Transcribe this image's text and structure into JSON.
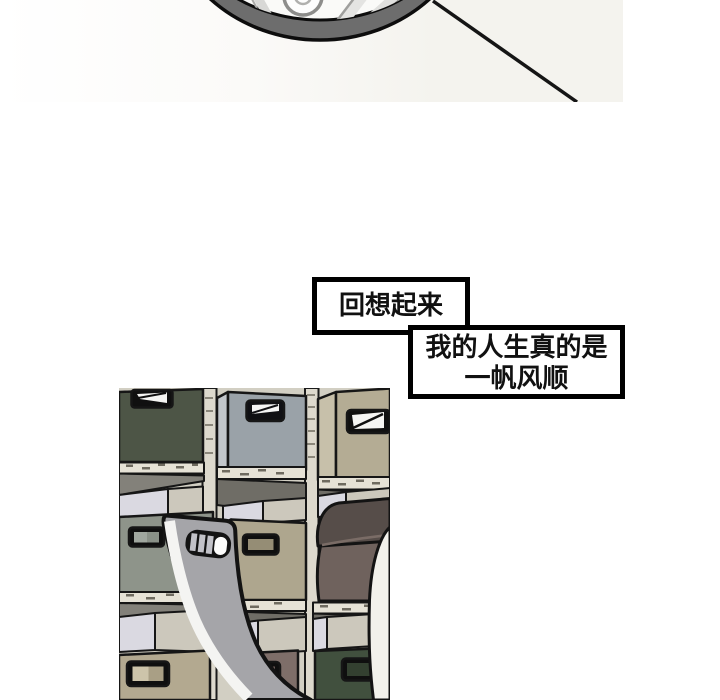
{
  "page": {
    "background_color": "#ffffff",
    "kind": "comic-page"
  },
  "top_panel": {
    "illustration": "bicycle-wheel-bottom-arc-with-frame-line",
    "backdrop_color": "#f4f3ee",
    "tire_color": "#6d6d6d",
    "rim_inner_color": "#fafaf8",
    "line_color": "#151515"
  },
  "speech": {
    "bubble1": {
      "text": "回想起来"
    },
    "bubble2": {
      "line1": "我的人生真的是",
      "line2": "一帆风顺"
    },
    "border_color": "#000000",
    "fill_color": "#ffffff",
    "text_color": "#111111"
  },
  "shelf_panel": {
    "illustration": "storage-cubbies-with-chair-back",
    "colors": {
      "base": "#d2cfc3",
      "frame": "#ddd9cd",
      "shelf_band": "#e6e2d6",
      "shelf_top": "#83817a",
      "shelf_top_dark": "#6f6d66",
      "box_dark_green": "#4d5546",
      "box_blue_gray": "#9aa2a8",
      "box_khaki": "#b4ac94",
      "box_gray_green": "#8e948a",
      "box_khaki2": "#aea68e",
      "box_beige": "#b3a990",
      "box_mauve": "#7e6e69",
      "box_forest": "#41503e",
      "box_top_lavender": "#dad9e1",
      "box_top_greige": "#ccc8bc",
      "chair_gray": "#a5a5a9",
      "chair_highlight": "#f4f4f2",
      "cushion_dark": "#564d49",
      "cushion_front": "#6f625d",
      "white_object": "#f2f1eb",
      "outline": "#141414"
    }
  }
}
